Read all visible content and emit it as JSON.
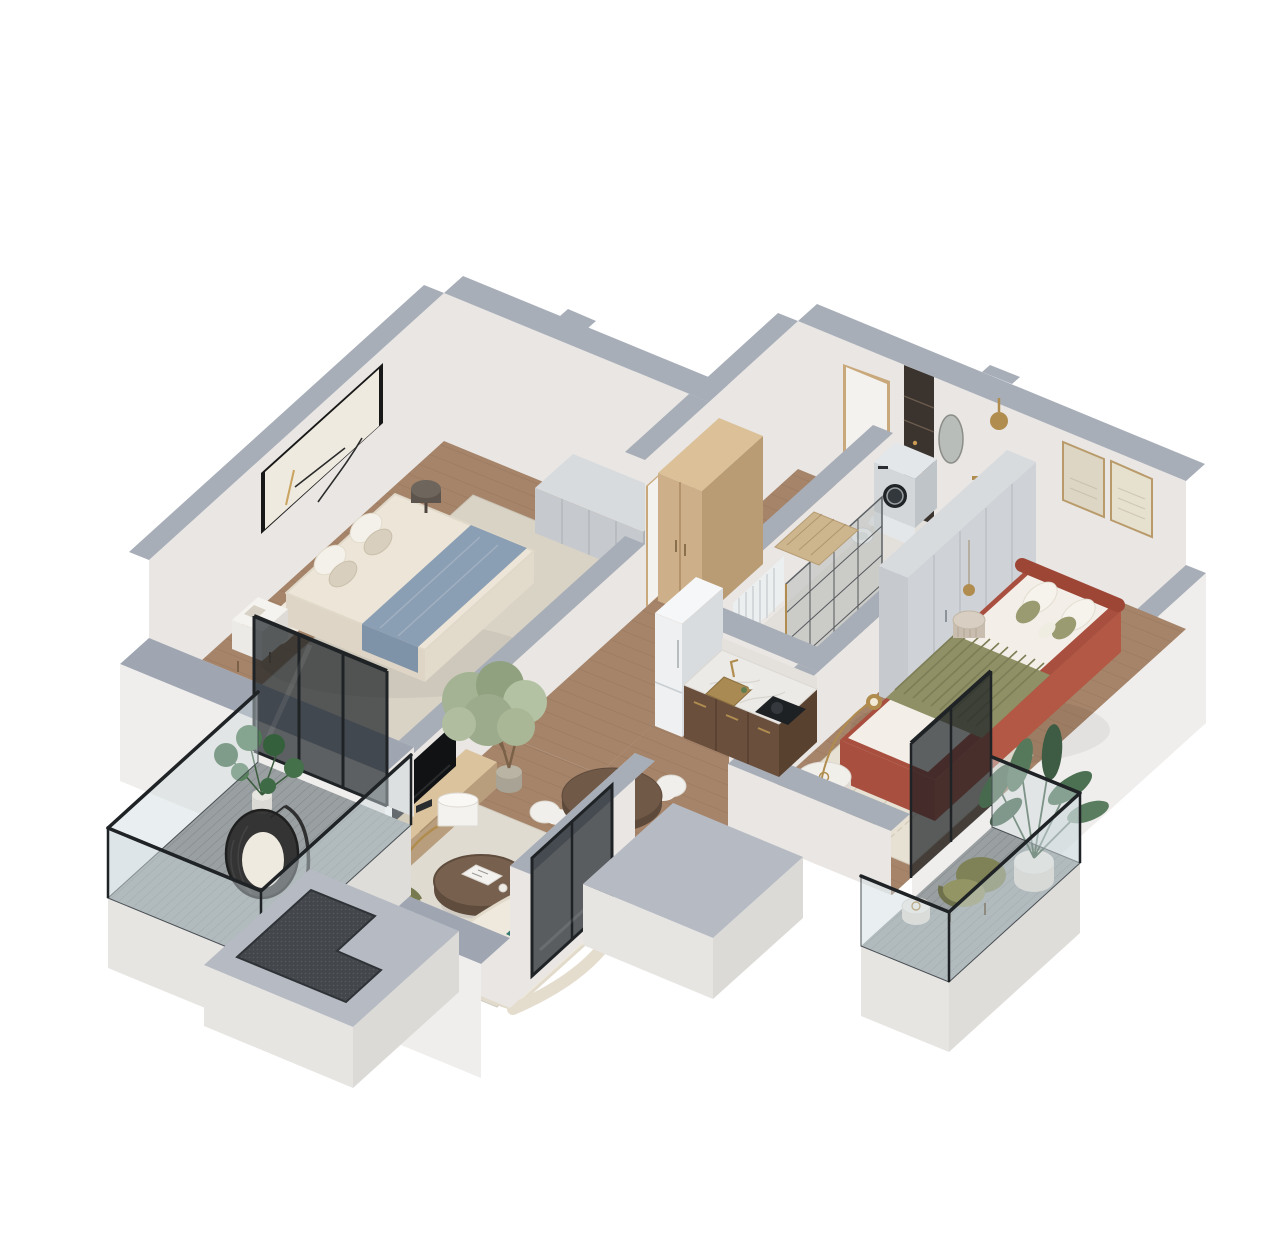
{
  "meta": {
    "description": "Isometric cutaway 3D render of a one-bedroom-plus-living apartment floor plan with two balconies, white walls with gray cut caps and oak flooring"
  },
  "palette": {
    "wall": "#e9e6e3",
    "wallShade": "#dbd8d4",
    "wallOuter": "#f0eeec",
    "cap": "#a8aeb8",
    "capNear": "#9fa6b2",
    "wood": "#a5846a",
    "woodDark": "#8f7057",
    "tile": "#e3e0dc",
    "deck": "#9aa0a2",
    "slab": "#b6bbc3",
    "slabFace": "#e7e5e2",
    "mesh": "#43474b",
    "frameBlack": "#1f2326",
    "glassTint": "rgba(206,217,222,0.45)",
    "glassDark": "rgba(22,28,32,0.68)",
    "cream": "#efe9dd",
    "creamShade": "#e0d8c8",
    "linen": "#ece5d8",
    "linenShade": "#ded5c6",
    "sand": "#d9cfbf",
    "blue": "#8b9fb4",
    "blueDark": "#7f93a8",
    "terra": "#a94f3f",
    "terraDark": "#9e4636",
    "terraLight": "#b25844",
    "olive": "#8f9066",
    "oliveDark": "#7c7e55",
    "oliveSoft": "#9a9b70",
    "teal": "#35786f",
    "walnut": "#6a4f3d",
    "walnutDark": "#59412f",
    "oak": "#cdb089",
    "oakDark": "#b99b74",
    "oakTop": "#dbc098",
    "marble": "#eceae6",
    "grayFurn": "#c6c9cd",
    "grayFurnDark": "#b0b4b8",
    "grayFurnTop": "#d8dbde",
    "white": "#f1efeb",
    "whiteShade": "#dcd8cf",
    "gold": "#b08d4f",
    "bronze": "#3a332e",
    "plant": "#4a7a50",
    "plantDark": "#3e6b45",
    "plantSoft": "#a7b796",
    "appliance": "#eef0f1",
    "applianceShade": "#d9dcde",
    "rugA": "#d9d3c6",
    "rugB": "#e0dbd1",
    "rugC": "#e7e1d4",
    "mat": "#cdb68e"
  },
  "scene": {
    "type": "isometric-3d-floor-plan",
    "rooms": [
      {
        "id": "master-bedroom",
        "furniture": [
          "double-bed",
          "rounded-headboard",
          "blue-throw",
          "pillows",
          "nightstand",
          "round-side-table",
          "gray-sideboard",
          "area-rug",
          "framed-wall-art",
          "sliding-glass-doors"
        ]
      },
      {
        "id": "hallway",
        "furniture": [
          "oak-wardrobe",
          "entry-door",
          "interior-door",
          "doormat"
        ]
      },
      {
        "id": "bathroom",
        "furniture": [
          "storage-niche",
          "washing-machine",
          "toilet",
          "shower-enclosure",
          "shower-head",
          "oval-mirror",
          "radiator",
          "water-heater"
        ]
      },
      {
        "id": "kitchen",
        "furniture": [
          "walnut-base-cabinets",
          "marble-countertop",
          "brass-sink",
          "cooktop",
          "refrigerator",
          "bottles"
        ]
      },
      {
        "id": "dining-area",
        "furniture": [
          "round-walnut-table",
          "dining-chair-north",
          "dining-chair-west",
          "dining-chair-east",
          "dining-chair-south"
        ]
      },
      {
        "id": "living-room",
        "furniture": [
          "curved-sofa",
          "teal-throw",
          "coffee-table",
          "book",
          "tv",
          "tv-console",
          "olive-armchair",
          "arc-floor-lamp",
          "potted-tree",
          "area-rug",
          "dark-window"
        ]
      },
      {
        "id": "bedroom-2",
        "furniture": [
          "terracotta-bed",
          "olive-striped-blanket",
          "pillows",
          "framed-art-pair",
          "gray-wardrobe",
          "pedestal-side-table",
          "white-round-table",
          "olive-ottoman",
          "arc-lamp",
          "pendant-lamp",
          "area-rug",
          "balcony-slider"
        ]
      },
      {
        "id": "balcony-southwest",
        "furniture": [
          "hanging-egg-chair",
          "monstera-plant",
          "glass-balustrade",
          "wood-decking"
        ]
      },
      {
        "id": "balcony-east",
        "furniture": [
          "olive-armchair",
          "white-side-table",
          "large-potted-plant",
          "glass-balustrade",
          "wood-decking"
        ]
      }
    ],
    "structures": [
      "exterior-walls",
      "gray-wall-caps",
      "utility-slab-south",
      "utility-slab-east",
      "mesh-shaft-opening"
    ]
  }
}
